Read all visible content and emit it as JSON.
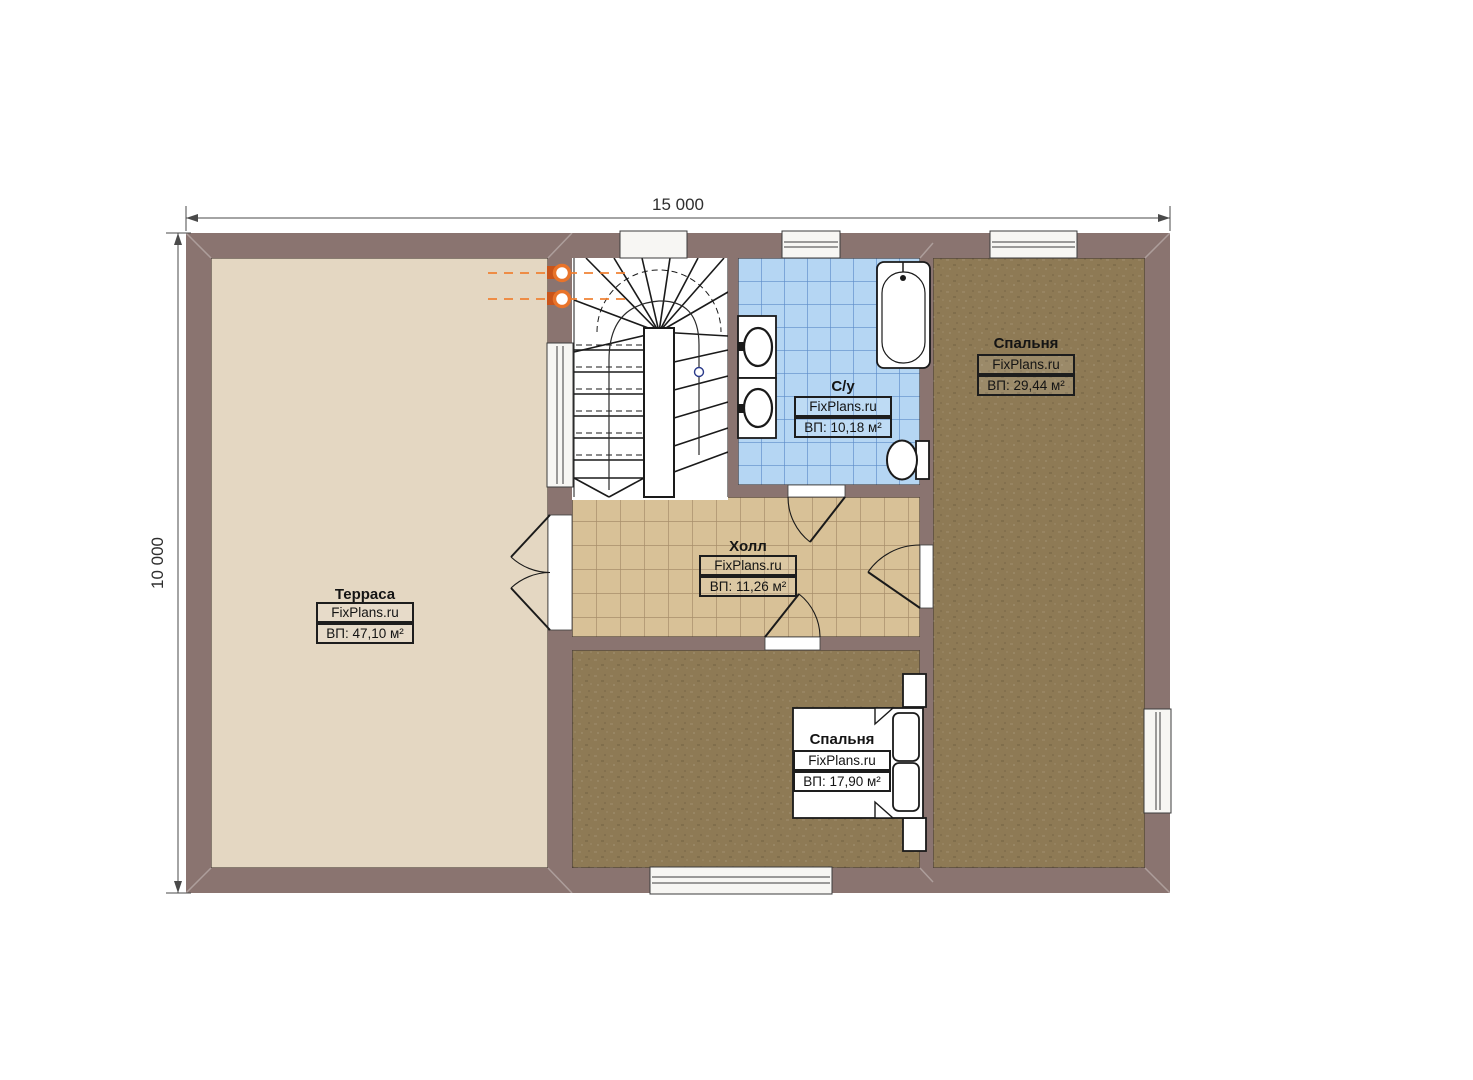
{
  "plan": {
    "type": "floor-plan",
    "dimensions": {
      "width": "15 000",
      "height": "10 000"
    },
    "rooms": {
      "terrace": {
        "name": "Терраса",
        "brand": "FixPlans.ru",
        "area": "ВП: 47,10 м²"
      },
      "hall": {
        "name": "Холл",
        "brand": "FixPlans.ru",
        "area": "ВП: 11,26 м²"
      },
      "bathroom": {
        "name": "С/у",
        "brand": "FixPlans.ru",
        "area": "ВП: 10,18 м²"
      },
      "bedroom_right": {
        "name": "Спальня",
        "brand": "FixPlans.ru",
        "area": "ВП: 29,44 м²"
      },
      "bedroom_bottom": {
        "name": "Спальня",
        "brand": "FixPlans.ru",
        "area": "ВП: 17,90 м²"
      }
    },
    "colors": {
      "wall": "#8a7470",
      "terrace_floor": "#e4d7c2",
      "hall_tile": "#d8c197",
      "bedroom_floor": "#8e7a55",
      "bathroom_tile": "#b5d6f3",
      "stair_area": "#ffffff",
      "accent_orange": "#e8732a",
      "line": "#1a1a1a"
    }
  }
}
